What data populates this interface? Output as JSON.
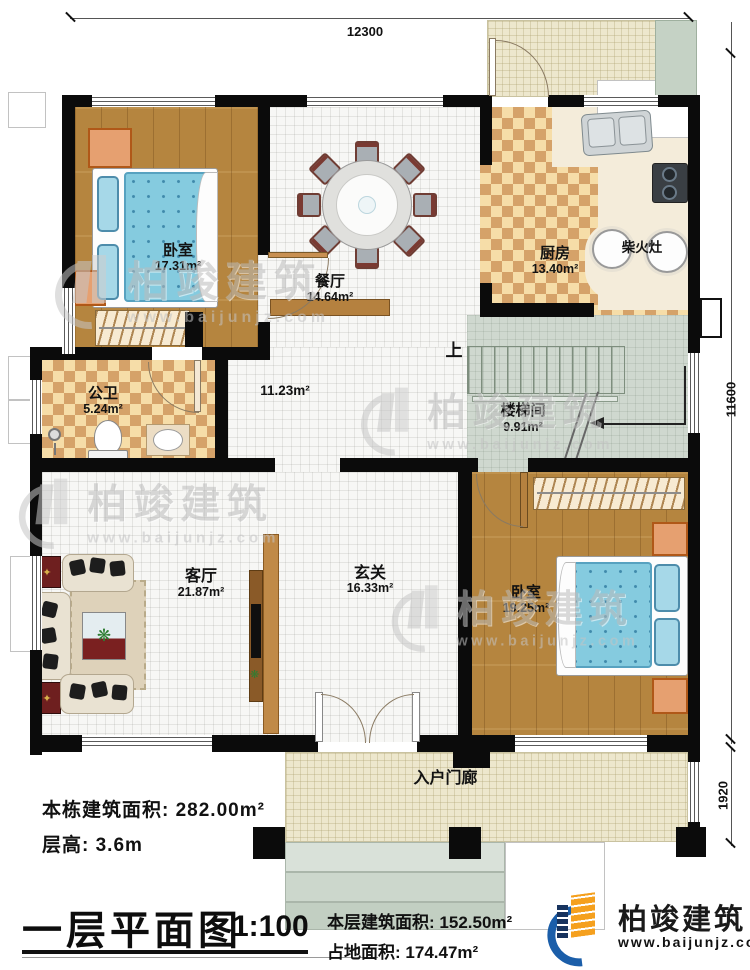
{
  "plan": {
    "title": "一层平面图",
    "scale": "1:100"
  },
  "dimensions": {
    "top_width": "12300",
    "right_height": "11600",
    "porch_depth": "1920"
  },
  "rooms": {
    "bedroom1": {
      "name": "卧室",
      "area": "17.31m²"
    },
    "dining": {
      "name": "餐厅",
      "area": "14.64m²"
    },
    "kitchen": {
      "name": "厨房",
      "area": "13.40m²"
    },
    "bathroom": {
      "name": "公卫",
      "area": "5.24m²"
    },
    "hallway": {
      "area": "11.23m²"
    },
    "stairwell": {
      "name": "楼梯间",
      "area": "9.91m²"
    },
    "living": {
      "name": "客厅",
      "area": "21.87m²"
    },
    "foyer": {
      "name": "玄关",
      "area": "16.33m²"
    },
    "bedroom2": {
      "name": "卧室",
      "area": "19.25m²"
    },
    "porch": {
      "name": "入户门廊"
    }
  },
  "labels": {
    "stair_up": "上",
    "wood_stove": "柴火灶"
  },
  "notes": {
    "building_area_label": "本栋建筑面积:",
    "building_area_value": "282.00m²",
    "floor_height_label": "层高:",
    "floor_height_value": "3.6m",
    "floor_area_label": "本层建筑面积:",
    "floor_area_value": "152.50m²",
    "footprint_label": "占地面积:",
    "footprint_value": "174.47m²"
  },
  "brand": {
    "name": "柏竣建筑",
    "website": "www.baijunjz.com"
  },
  "watermark": {
    "name": "柏竣建筑",
    "website": "www.baijunjz.com"
  },
  "colors": {
    "accent_blue": "#1b5ea9",
    "accent_orange": "#f5a01e",
    "wall": "#0b0b0b"
  }
}
